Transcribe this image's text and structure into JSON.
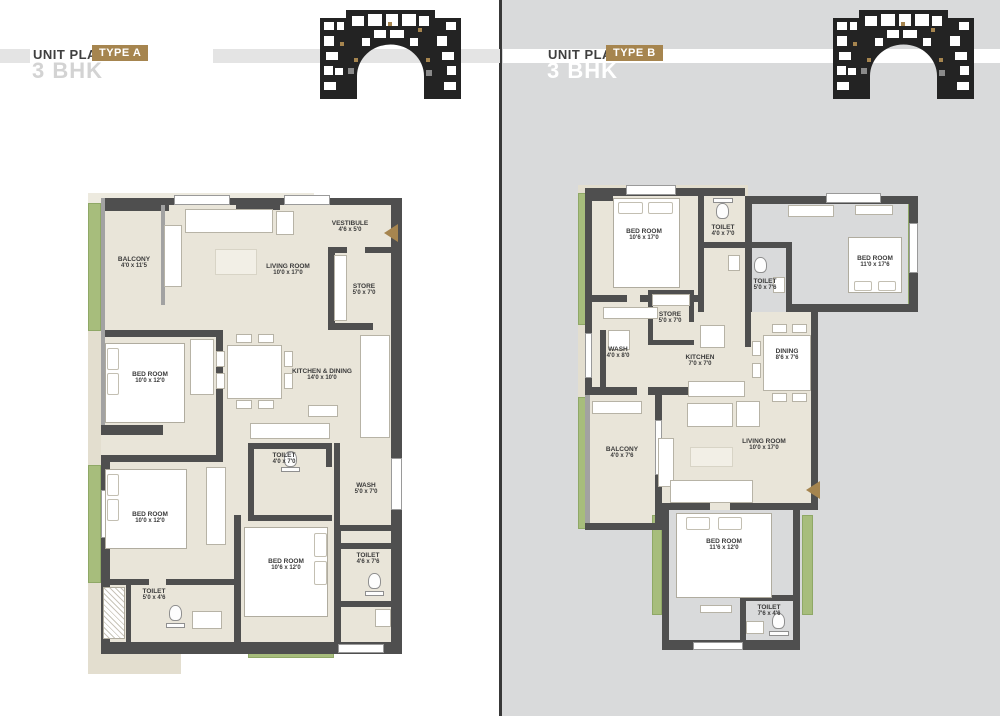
{
  "colors": {
    "accent_brown": "#a6854f",
    "wall_gray": "#4f4f4f",
    "floor_beige": "#e9e5d9",
    "landscape_green": "#a7bd7c",
    "right_panel_bg": "#d9dadb",
    "stripe_gray": "#e4e4e4"
  },
  "panels": [
    {
      "header": {
        "title": "UNIT PLAN",
        "badge": "TYPE A",
        "subtitle": "3 BHK"
      },
      "rooms": [
        {
          "name": "BALCONY",
          "dims": "4'0 x 11'5"
        },
        {
          "name": "LIVING ROOM",
          "dims": "10'0 x 17'0"
        },
        {
          "name": "VESTIBULE",
          "dims": "4'6 x 5'0"
        },
        {
          "name": "STORE",
          "dims": "5'0 x 7'0"
        },
        {
          "name": "BED ROOM",
          "dims": "10'0 x 12'0"
        },
        {
          "name": "KITCHEN & DINING",
          "dims": "14'0 x 10'0"
        },
        {
          "name": "TOILET",
          "dims": "4'0 x 7'0"
        },
        {
          "name": "WASH",
          "dims": "5'0 x 7'0"
        },
        {
          "name": "BED ROOM",
          "dims": "10'0 x 12'0"
        },
        {
          "name": "TOILET",
          "dims": "5'0 x 4'6"
        },
        {
          "name": "BED ROOM",
          "dims": "10'6 x 12'0"
        },
        {
          "name": "TOILET",
          "dims": "4'6 x 7'6"
        }
      ]
    },
    {
      "header": {
        "title": "UNIT PLAN",
        "badge": "TYPE B",
        "subtitle": "3 BHK"
      },
      "rooms": [
        {
          "name": "BED ROOM",
          "dims": "10'6 x 17'0"
        },
        {
          "name": "TOILET",
          "dims": "4'0 x 7'0"
        },
        {
          "name": "TOILET",
          "dims": "5'0 x 7'6"
        },
        {
          "name": "BED ROOM",
          "dims": "11'0 x 17'6"
        },
        {
          "name": "STORE",
          "dims": "5'0 x 7'0"
        },
        {
          "name": "WASH",
          "dims": "4'0 x 8'0"
        },
        {
          "name": "KITCHEN",
          "dims": "7'0 x 7'0"
        },
        {
          "name": "DINING",
          "dims": "8'6 x 7'6"
        },
        {
          "name": "LIVING ROOM",
          "dims": "10'0 x 17'0"
        },
        {
          "name": "BALCONY",
          "dims": "4'0 x 7'6"
        },
        {
          "name": "BED ROOM",
          "dims": "11'6 x 12'0"
        },
        {
          "name": "TOILET",
          "dims": "7'6 x 4'6"
        }
      ]
    }
  ]
}
